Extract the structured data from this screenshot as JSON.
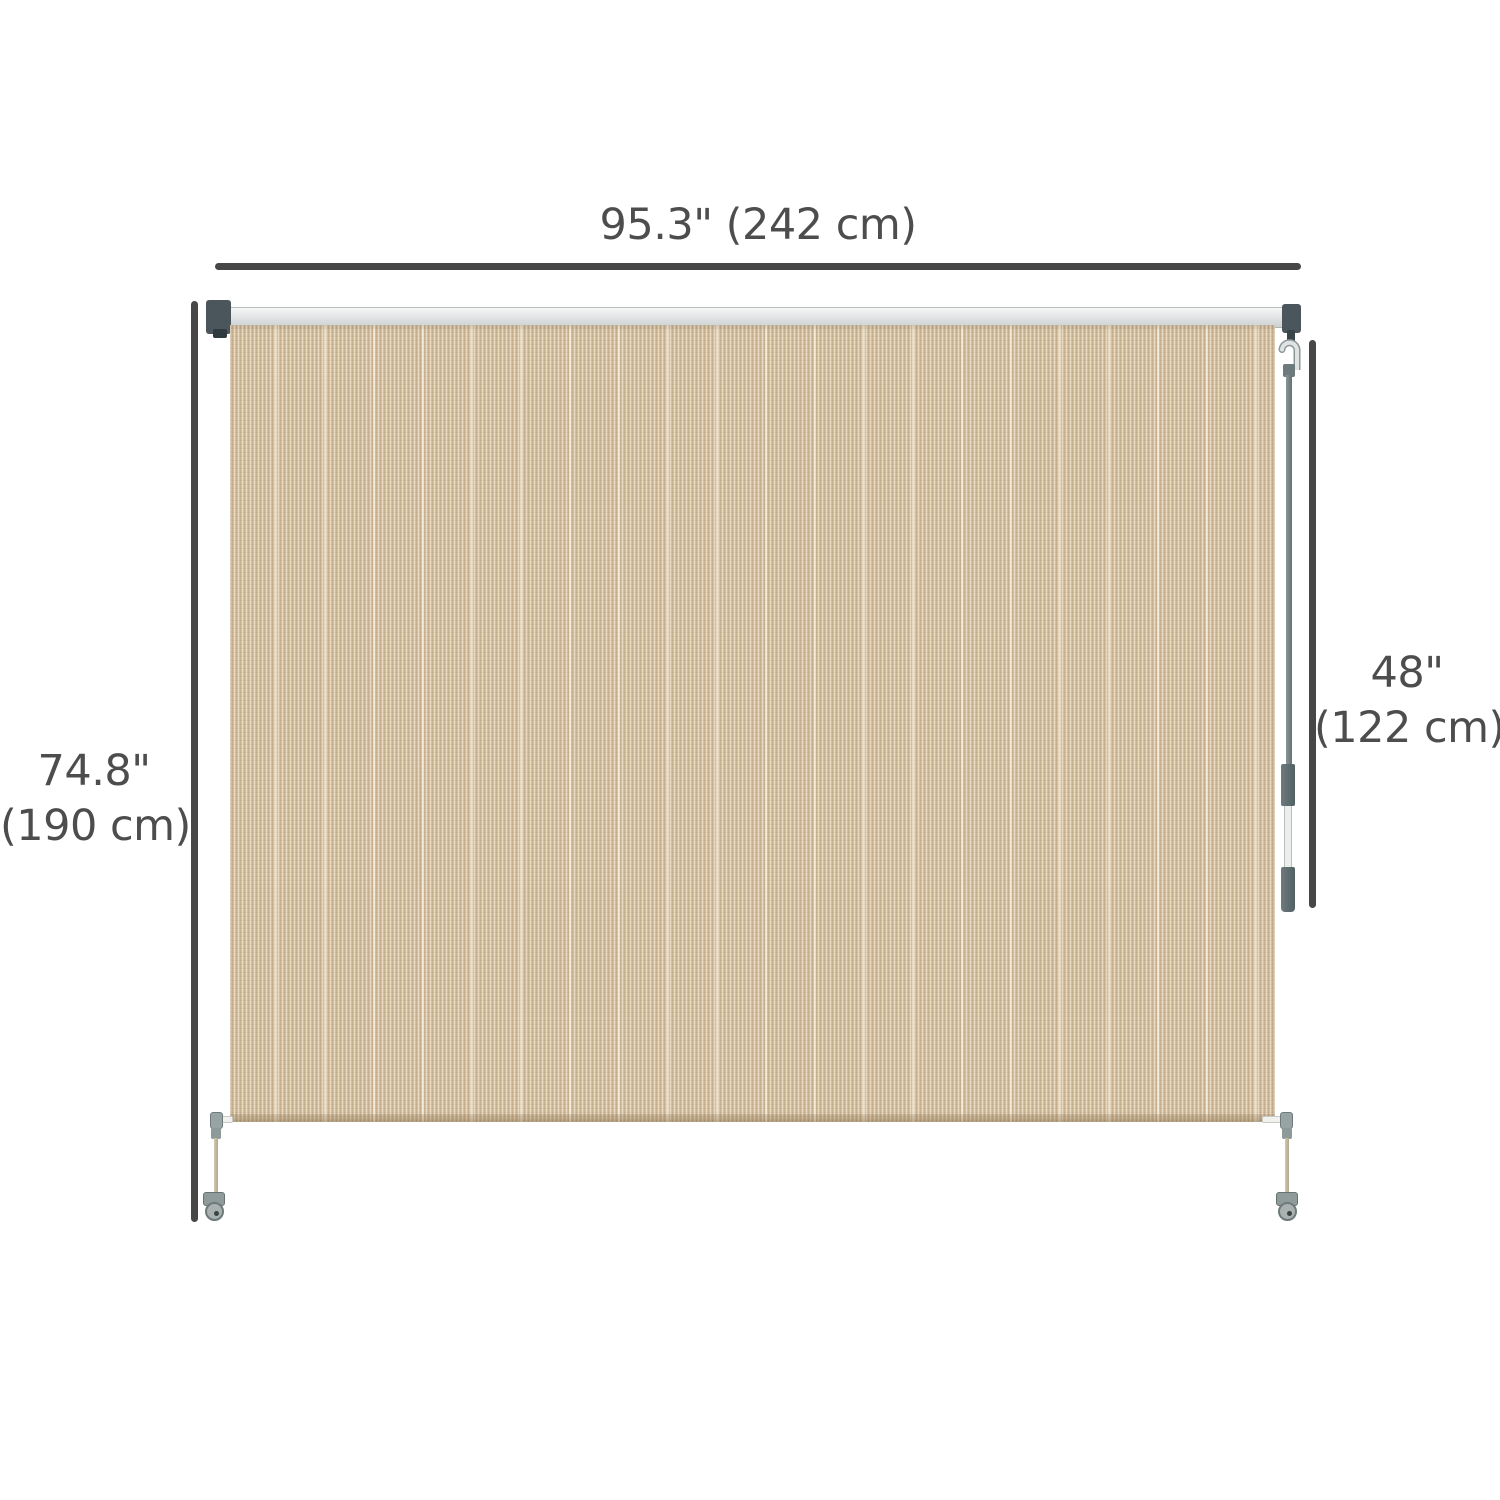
{
  "figure": {
    "type": "product-dimension-diagram",
    "subject": "outdoor roller shade blind with crank handle",
    "background_color": "#ffffff",
    "line_color": "#474747",
    "text_color": "#4d4d4d"
  },
  "dimensions": {
    "width": {
      "label": "95.3\" (242 cm)"
    },
    "height": {
      "value": "74.8\"",
      "metric": "(190 cm)"
    },
    "crank_length": {
      "value": "48\"",
      "metric": "(122 cm)"
    }
  },
  "parts": {
    "rail_color": "#e3e5e6",
    "bracket_color": "#4a565b",
    "fabric_color": "#d6c0a0",
    "hem_color": "#c2aa85",
    "pole_color": "#657275",
    "pole_grip_color": "#516063",
    "hook_color": "#dfe3e3",
    "clamp_color": "#8f9b9b",
    "cable_color": "#b3a88d"
  }
}
